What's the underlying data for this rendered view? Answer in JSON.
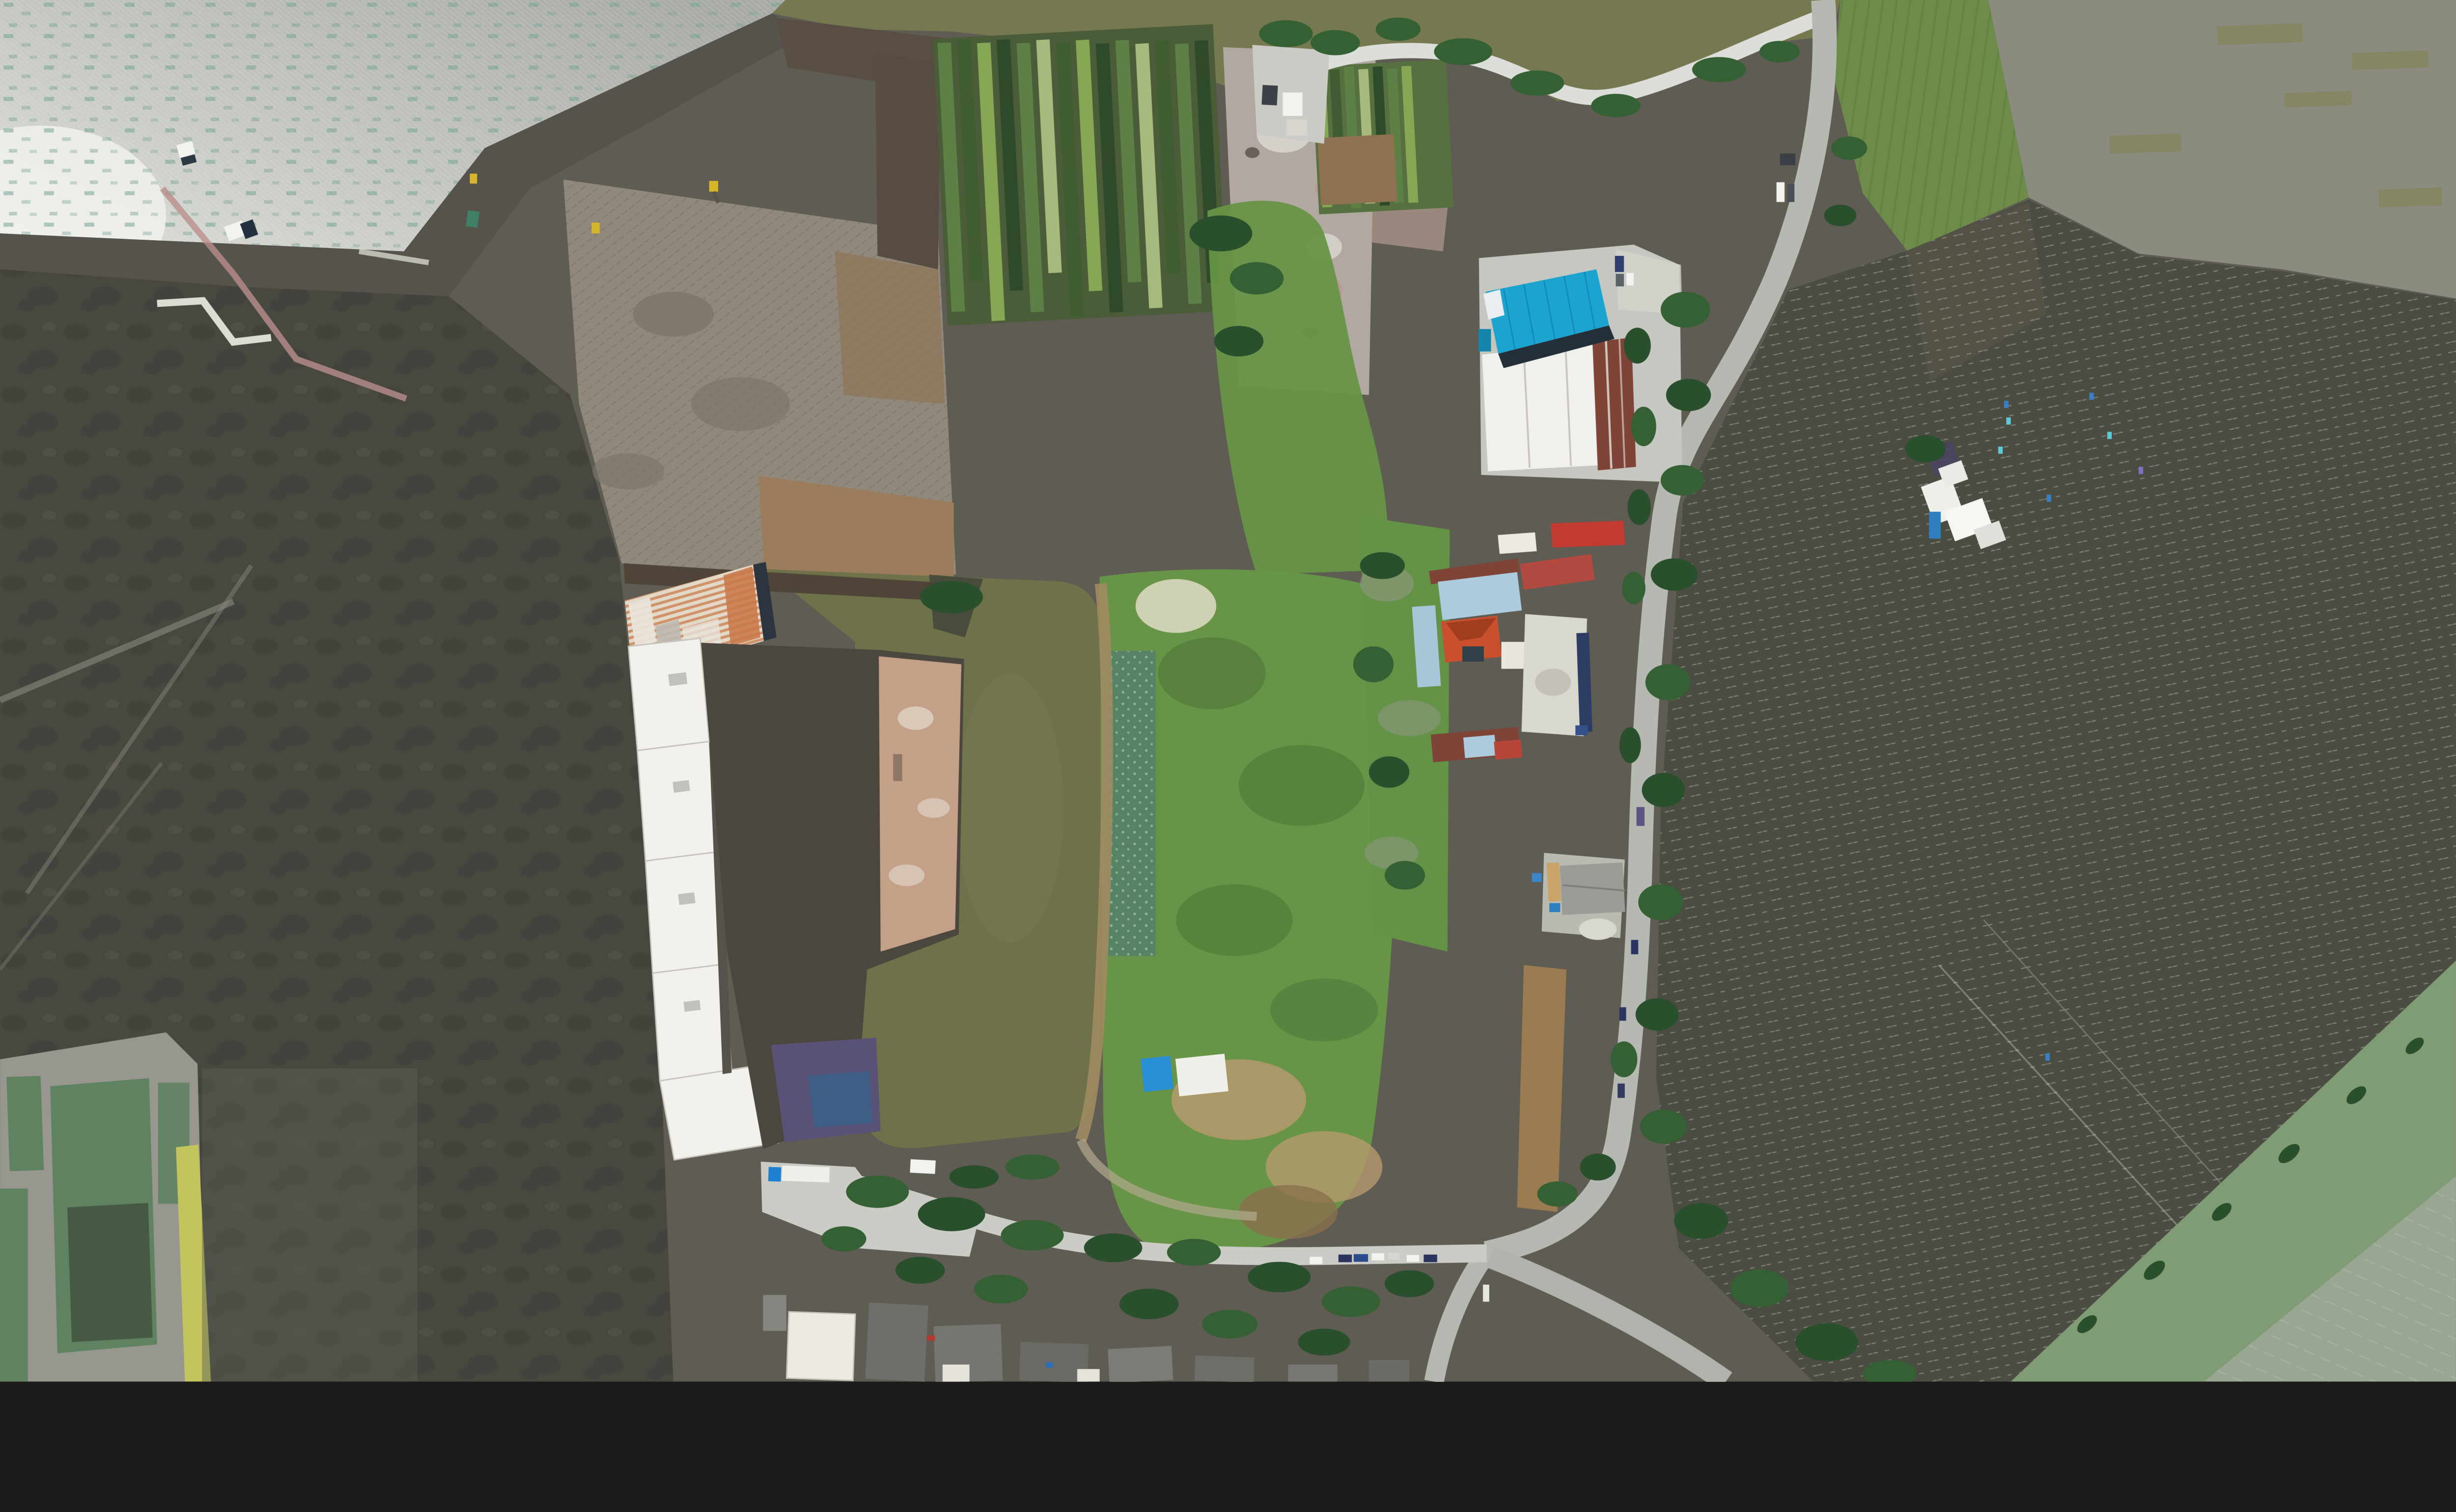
{
  "scene": {
    "title": "Aerial drone photo of lakeside farmland, warehouses and aquaculture fields",
    "description": "Top-down orthophoto: sun-glint lake water at top-left, dark excavated earthworks and charcoal fields on the left with small fish ponds at bottom-left, a large white-and-orange roofed warehouse around a green farm pond in the center, vegetable plots and a cyan-roofed warehouse plus farm compound along a vertical road on the right, and a vast dark net-covered aquaculture field on the right side."
  },
  "palette": {
    "glint_hi": "#a9aca6",
    "glint_mid": "#c7c9c3",
    "glint_lo": "#f2f3ef",
    "teal_speck": "#74a193",
    "olive_water": "#76794f",
    "muddy_pond": "#8b8b80",
    "muddy_olive": "#85865f",
    "paddy_green": "#6d8c49",
    "paddy_row": "#4e6b36",
    "shore_dark": "#55534b",
    "land_base": "#5f5c53",
    "charcoal": "#484841",
    "charcoal_blot": "#3a3a35",
    "cleared_tan": "#90887a",
    "log_streak": "#6c665a",
    "dirt_brown": "#9b7d5c",
    "plow_brown": "#594e43",
    "dark_field_brown": "#564c41",
    "pad_gray": "#b1a8a1",
    "pad_pink": "#b9948e",
    "pad_white": "#d9d4ce",
    "crop_a": "#86a855",
    "crop_b": "#3f5c33",
    "crop_c": "#5d8046",
    "crop_d": "#a8b97e",
    "crop_e": "#2f4a2a",
    "crop_base": "#4a5c38",
    "green_field": "#679446",
    "green_dark": "#4c7437",
    "cabbage": "#53806a",
    "dry_pale": "#ced2b2",
    "tan_patch": "#b59a6e",
    "brown_patch": "#8a6f4e",
    "pond_olive": "#6e7149",
    "pond_bank_dark": "#3f4437",
    "pond_path": "#a08b62",
    "court_dark": "#4b473f",
    "court_purple": "#5a5276",
    "court_blue": "#3f5e85",
    "inner_tan": "#c5a089",
    "roof_white": "#f2f1ec",
    "roof_seam": "#c6c4bd",
    "roof_orange": "#cd8557",
    "roof_orange_deep": "#c97a4b",
    "roof_base_cream": "#e3d9c9",
    "roof_navy_edge": "#2c3440",
    "cyan_roof": "#1ba4cf",
    "cyan_edge": "#232e38",
    "white_bldg": "#f1f0ec",
    "maroon_roof": "#7e4438",
    "red_roof": "#c23b30",
    "orange_red": "#c9502e",
    "pale_blue": "#aecadd",
    "pink_red_roof": "#b24a41",
    "navy_tarp": "#2c3c63",
    "road_gray": "#b6b8b2",
    "road_white": "#dcded9",
    "concrete": "#cbccc6",
    "concrete_lt": "#d3d3cc",
    "tree": "#346033",
    "tree_dark": "#2a4f2c",
    "grass": "#649247",
    "verge": "#6d9a52",
    "net_field": "#4b4d43",
    "net_line": "#e6ebe4",
    "net_brown": "#5d5748",
    "corner_band": "#7f9c74",
    "corner_field": "#99a692",
    "fishpond": "#5f8261",
    "bank": "#97978f",
    "yellow_strip": "#c3c45e",
    "veh_white": "#f2f3ef",
    "veh_navy": "#2c3560",
    "veh_blue": "#1f7fd0",
    "veh_yellow": "#d8b62a",
    "veh_dark": "#3c4148",
    "veh_silver": "#c9cbc8",
    "marker_cyan": "#5ec8d8",
    "marker_blue": "#3a7fc2",
    "shed_blue": "#2b8fd6",
    "shed_white": "#eff0ea",
    "tarp_blue": "#2e7fc0"
  },
  "regions": [
    {
      "label": "Sun-glint lake water"
    },
    {
      "label": "Olive lake water"
    },
    {
      "label": "Shoreline embankment"
    },
    {
      "label": "Muddy pond"
    },
    {
      "label": "Rice paddy strip"
    },
    {
      "label": "Net-covered aquaculture field"
    },
    {
      "label": "Corner field bands"
    },
    {
      "label": "Charcoal burnt fields"
    },
    {
      "label": "Fish ponds"
    },
    {
      "label": "Cleared earthworks"
    },
    {
      "label": "Vegetable crop strips"
    },
    {
      "label": "Gravel staging pad"
    },
    {
      "label": "Central vegetable field"
    },
    {
      "label": "Farm pond"
    },
    {
      "label": "Warehouse complex"
    },
    {
      "label": "Blue-roof warehouse"
    },
    {
      "label": "Farm compound"
    },
    {
      "label": "Roadside sheds"
    },
    {
      "label": "Main road"
    },
    {
      "label": "Lakeside road"
    },
    {
      "label": "Village lane"
    },
    {
      "label": "Village houses"
    },
    {
      "label": "Trees and hedges"
    },
    {
      "label": "Vehicles"
    },
    {
      "label": "Field markers"
    }
  ],
  "objects": {
    "parked_car_count": 8,
    "excavator_count": 3,
    "truck_count": 4,
    "net_marker_count": 8
  }
}
